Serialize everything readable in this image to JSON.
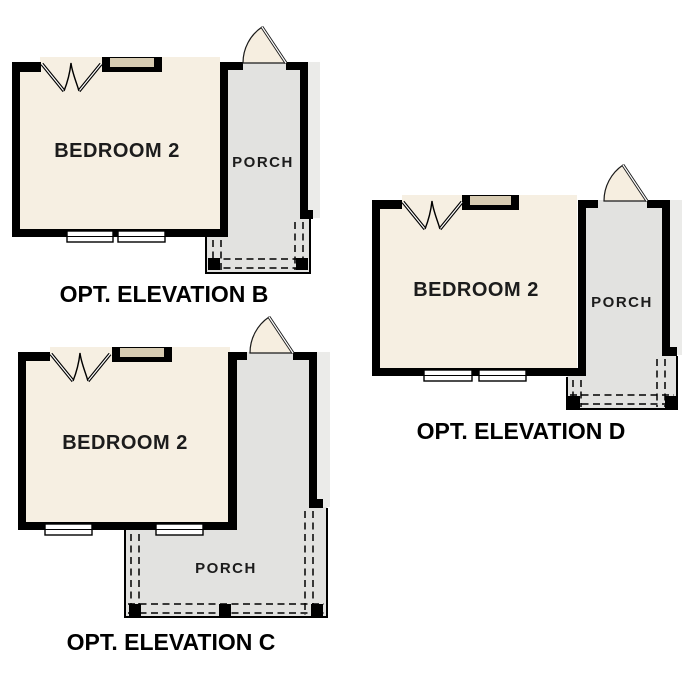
{
  "colors": {
    "background": "#ffffff",
    "wall": "#000000",
    "bedroom_fill": "#f6efe2",
    "porch_fill": "#e2e2e0",
    "house_edge_strip_fill": "#ebebe9",
    "window_header_fill": "#d7cbb2",
    "door_leaf_fill": "#f6eee0",
    "room_label_text": "#1c1c1c",
    "caption_text": "#000000"
  },
  "icons": [
    "double-door-icon",
    "door-swing-icon",
    "window-icon",
    "porch-post-icon"
  ],
  "plans": [
    {
      "id": "elevation-b",
      "caption": "OPT. ELEVATION B",
      "room_label": "BEDROOM 2",
      "porch_label": "PORCH"
    },
    {
      "id": "elevation-c",
      "caption": "OPT. ELEVATION C",
      "room_label": "BEDROOM 2",
      "porch_label": "PORCH"
    },
    {
      "id": "elevation-d",
      "caption": "OPT. ELEVATION D",
      "room_label": "BEDROOM 2",
      "porch_label": "PORCH"
    }
  ]
}
